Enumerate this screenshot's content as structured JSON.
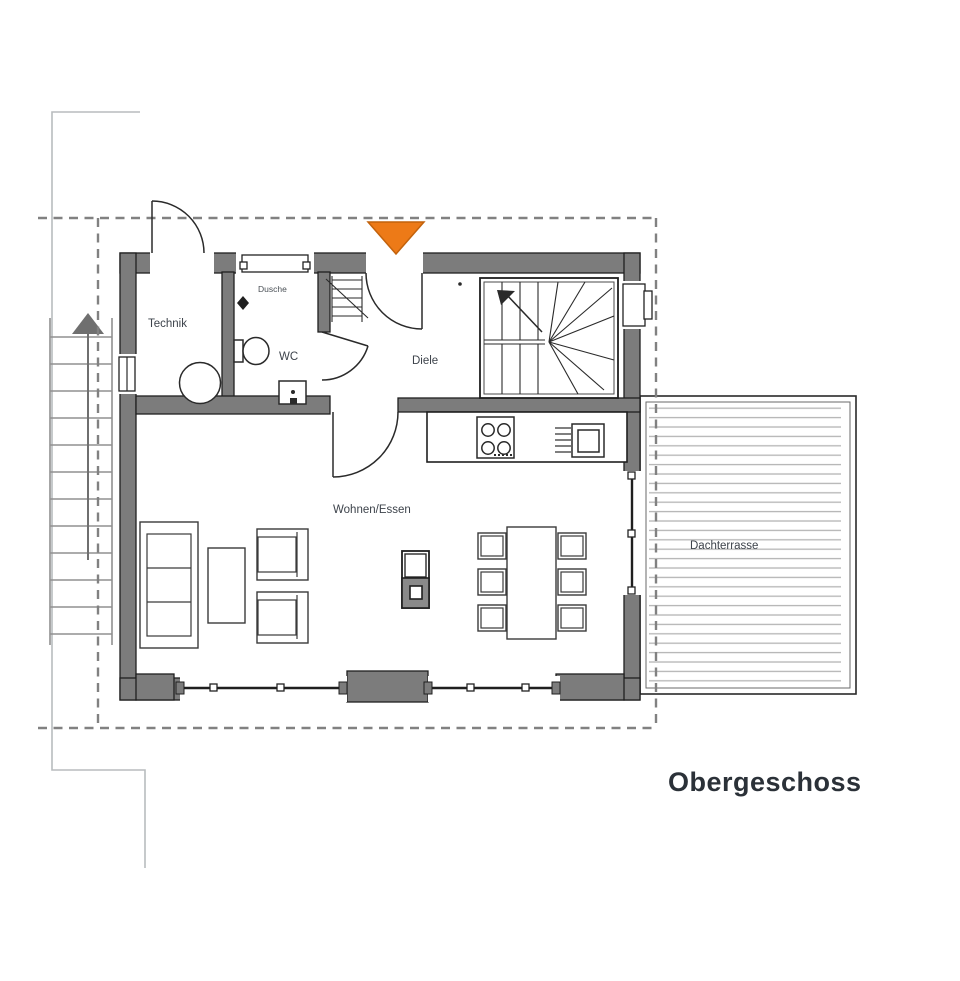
{
  "plan": {
    "floor_title": "Obergeschoss",
    "labels": {
      "technik": "Technik",
      "dusche": "Dusche",
      "wc": "WC",
      "diele": "Diele",
      "wohnen_essen": "Wohnen/Essen",
      "dachterrasse": "Dachterrasse"
    },
    "colors": {
      "entrance_marker": "#ed7a17",
      "entrance_marker_border": "#c2620c",
      "wall_fill": "#7c7c7c",
      "wall_outline": "#1f1f1f",
      "dashed_boundary": "#818181",
      "deck_lines": "#b4b4b4",
      "exterior_stair": "#909090",
      "faint_outline": "#b8bcbe",
      "furniture_line": "#3a3a3a",
      "room_label": "#3d434b",
      "title_text": "#2b3138"
    }
  }
}
